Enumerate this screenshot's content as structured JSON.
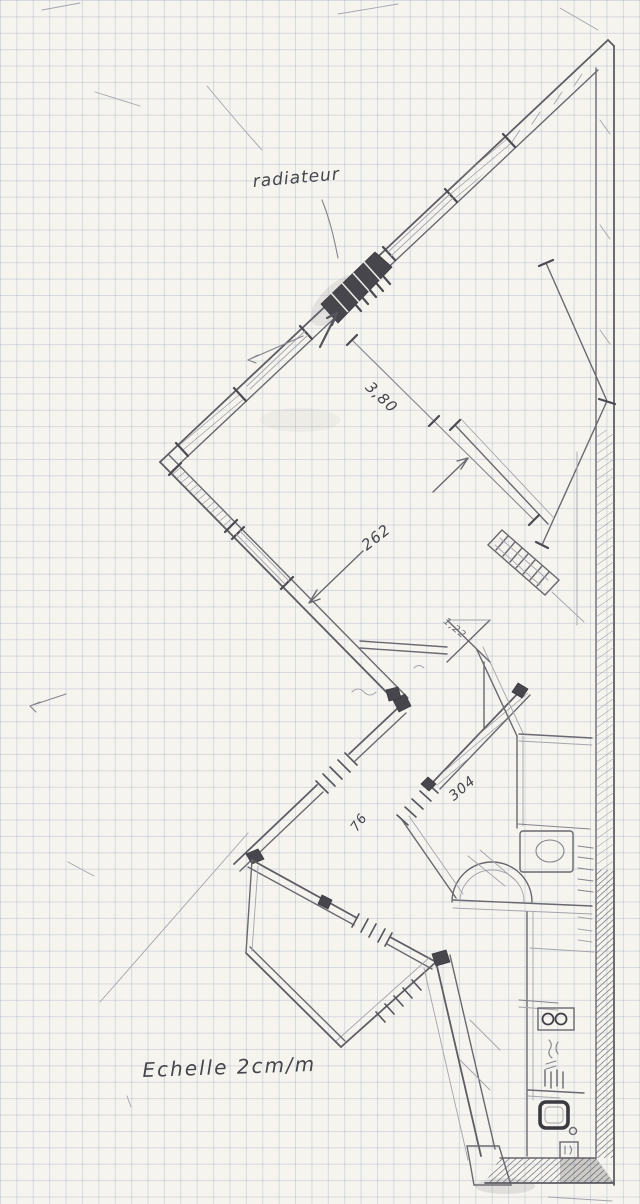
{
  "plan": {
    "labels": {
      "radiator": "radiateur",
      "dim_entry": "3,80",
      "dim_room": "262",
      "dim_small": "1,22",
      "dim_hall": "304",
      "dim_door": "76",
      "scale_note": "Echelle 2cm/m"
    },
    "palette": {
      "paper": "#f6f4ef",
      "grid_line": "#8a9eb6",
      "pencil": "#5d5d63",
      "pencil_dark": "#3a3a40",
      "pencil_light": "#a4a4ab"
    }
  }
}
